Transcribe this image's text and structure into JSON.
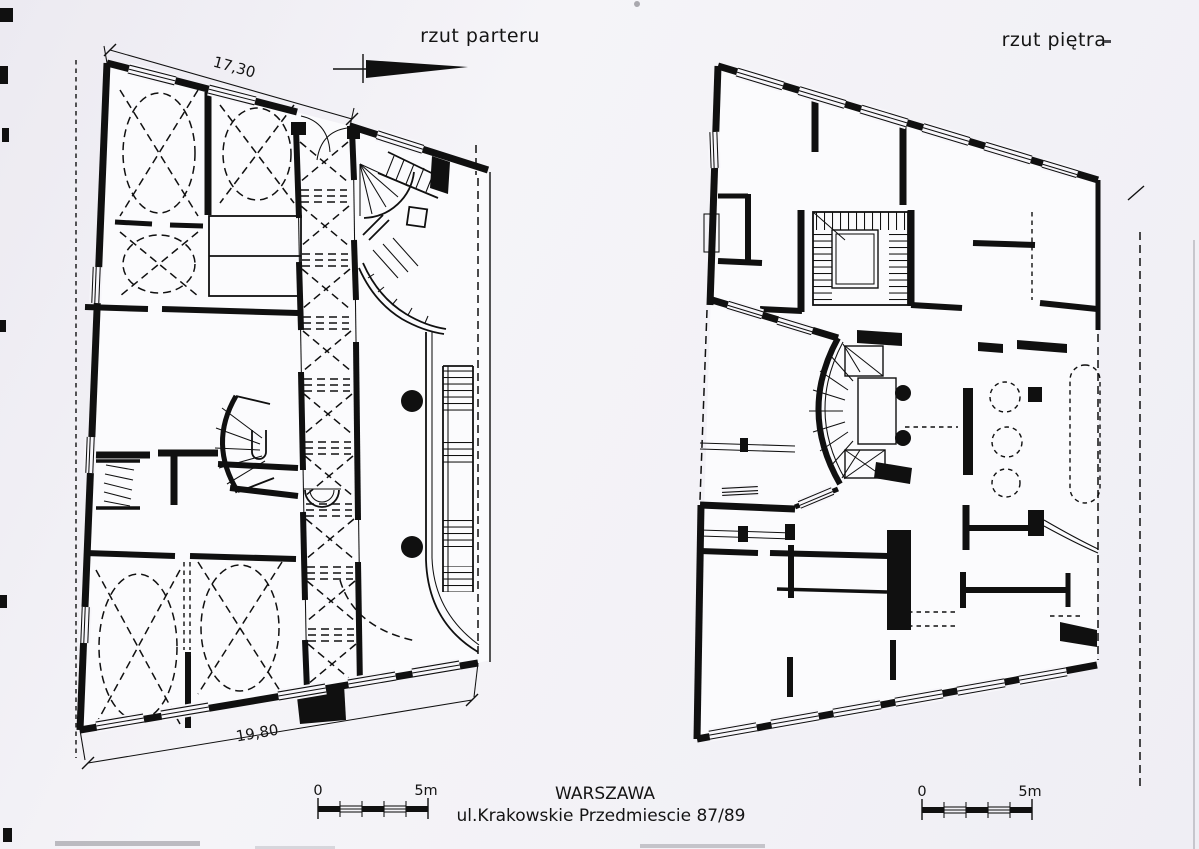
{
  "drawing": {
    "left_plan": {
      "title": "rzut parteru",
      "dimension_top": "17,30",
      "dimension_bottom": "19,80"
    },
    "right_plan": {
      "title": "rzut piętra"
    },
    "caption": {
      "line1": "WARSZAWA",
      "line2": "ul.Krakowskie Przedmiescie 87/89"
    },
    "scale_bar_left": {
      "start_label": "0",
      "end_label": "5m"
    },
    "scale_bar_right": {
      "start_label": "0",
      "end_label": "5m"
    },
    "ink_color": "#101010",
    "paper_color": "#f2f1f6"
  }
}
